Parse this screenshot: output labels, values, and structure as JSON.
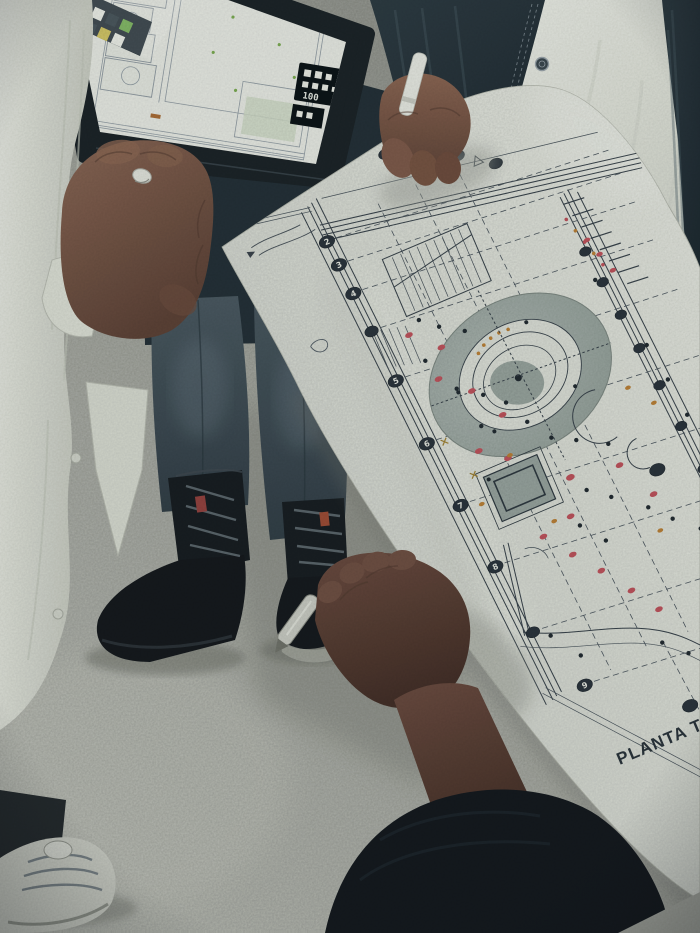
{
  "scene": {
    "type": "photograph",
    "description": "People gathered at a construction site reviewing a printed architectural floor plan and a tablet with a CAD drawing"
  },
  "blueprint": {
    "caption": "PLANTA T",
    "grid_labels": [
      "2",
      "3",
      "4",
      "5",
      "6",
      "7",
      "8",
      "9"
    ],
    "colors": {
      "paper": "#dcded6",
      "ink": "#39424a",
      "fill_gray": "#9fa9a3",
      "red_dot": "#c2525c",
      "orange_dot": "#bd8136",
      "marker": "#2b333b"
    }
  },
  "tablet": {
    "panel_label": "100",
    "colors": {
      "bezel": "#1b2125",
      "screen": "#e7e8e1",
      "toolbar_bg": "#232d34",
      "toolbar_green": "#6faa4b",
      "toolbar_yellow": "#c9b84a",
      "toolbar_white": "#e8e9e1",
      "toolbar_dark": "#2d3a40"
    }
  },
  "people": {
    "left": {
      "clothing": "white coat",
      "accessory": "ring"
    },
    "center": {
      "clothing": "dark jeans and black lace-up boots"
    },
    "right": {
      "clothing": "white t-shirt with dark denim jacket",
      "accessory": "white pen"
    },
    "bottom": {
      "clothing": "dark knit sleeve",
      "accessory": "metal pen"
    }
  },
  "palette": {
    "floor": "#a9aaa2",
    "shadow": "#82837b",
    "coat": "#dfe0d8",
    "shirt": "#e9eae2",
    "denim": "#27333a",
    "jeans": "#46535c",
    "boots": "#14181c",
    "skin_light": "#85604f",
    "skin_dark": "#5d4136",
    "concrete_wedge": "#a4a59d"
  }
}
